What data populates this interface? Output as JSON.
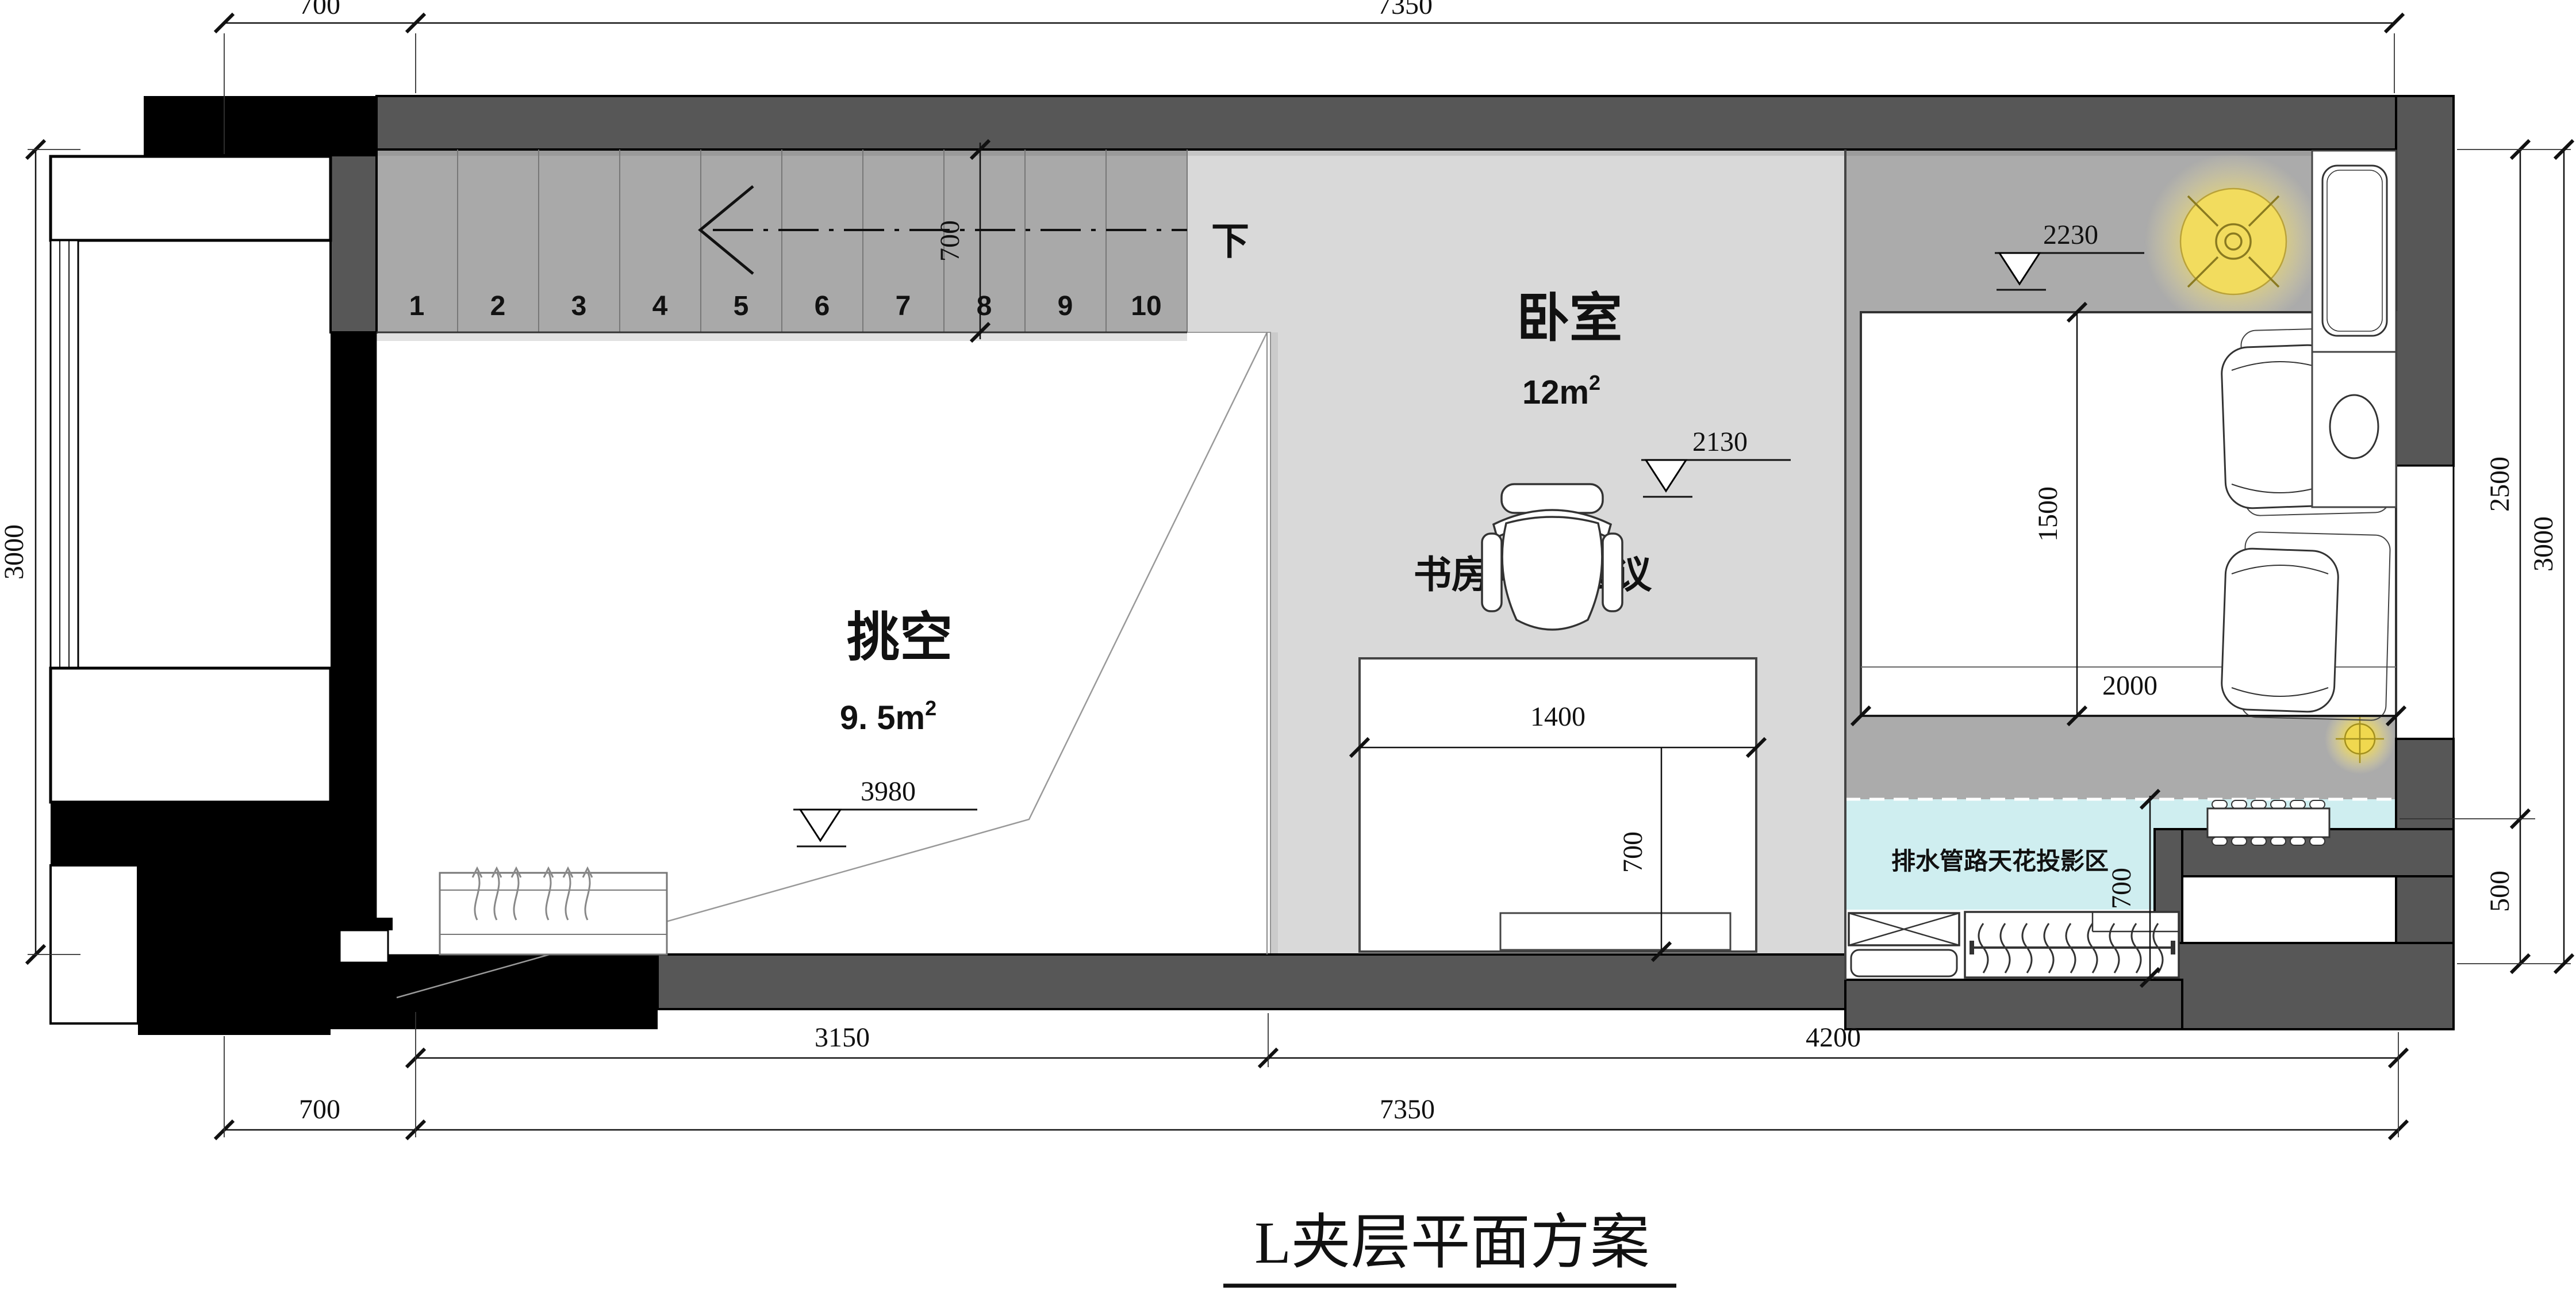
{
  "title": "L夹层平面方案",
  "stairs": {
    "numbers": [
      "1",
      "2",
      "3",
      "4",
      "5",
      "6",
      "7",
      "8",
      "9",
      "10"
    ],
    "down_label": "下",
    "width_dim": "700"
  },
  "rooms": {
    "void": {
      "name": "挑空",
      "area": "9. 5m",
      "area_sup": "2",
      "level": "3980"
    },
    "bedroom": {
      "name": "卧室",
      "area": "12m",
      "area_sup": "2",
      "level": "2130",
      "ceiling_level": "2230"
    },
    "study": {
      "name": "书房/视频会议"
    }
  },
  "notes": {
    "drain": "排水管路天花投影区"
  },
  "furniture_dims": {
    "desk_width": "1400",
    "desk_depth": "700",
    "bed_width": "1500",
    "bed_length": "2000",
    "closet_depth": "700"
  },
  "dimensions": {
    "top": [
      "700",
      "7350"
    ],
    "bottom_inner": [
      "3150",
      "4200"
    ],
    "bottom_outer": [
      "700",
      "7350"
    ],
    "left": [
      "3000"
    ],
    "right_inner": [
      "2500",
      "500"
    ],
    "right_outer": [
      "3000"
    ]
  },
  "colors": {
    "wall_gray": "#575757",
    "wall_black": "#000000",
    "stair_floor": "#a9a9a9",
    "study_floor": "#d9d9d9",
    "bedroom_floor": "#ababab",
    "drain_zone": "#cfeef0",
    "lamp_yellow": "#f2dc5e",
    "void_floor": "#ffffff"
  }
}
